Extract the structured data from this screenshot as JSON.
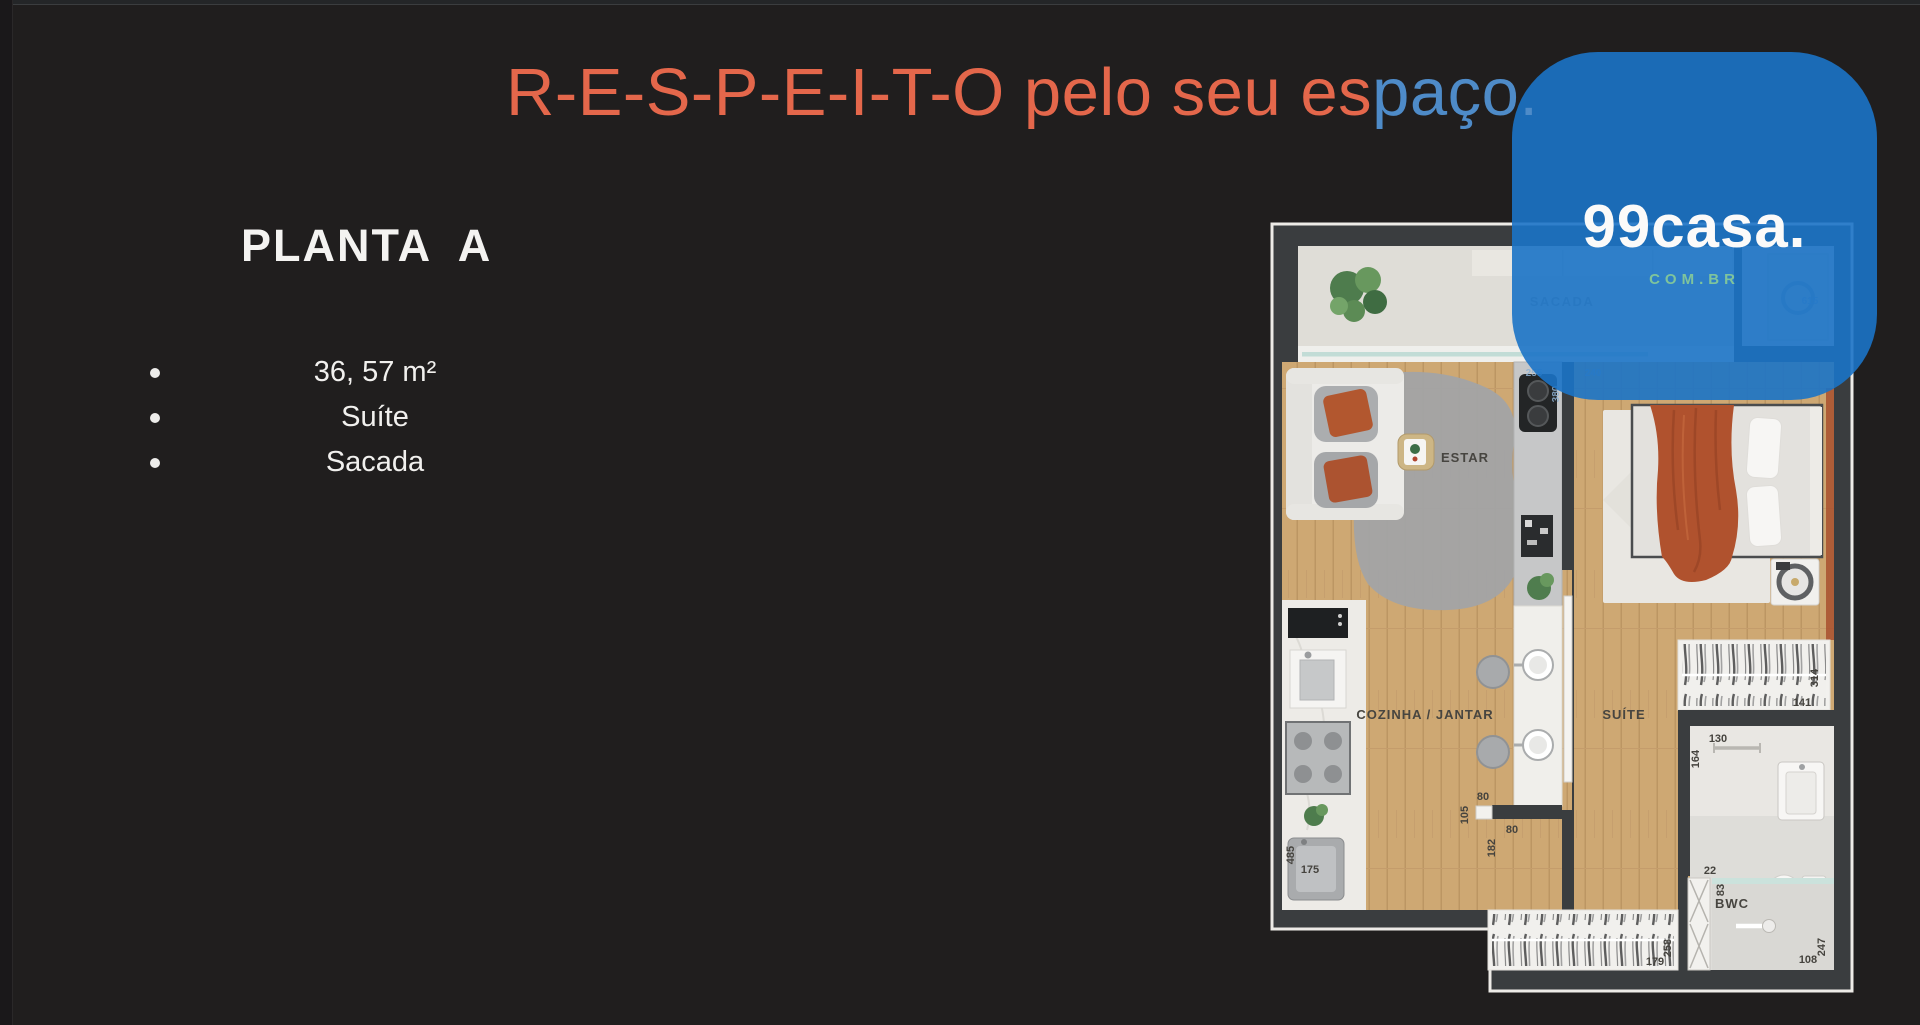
{
  "title": {
    "highlight": "R-E-S-P-E-I-T-O pelo seu es",
    "rest": "paço."
  },
  "panel": {
    "heading": "PLANTA  A",
    "bullets": [
      "36, 57 m²",
      "Suíte",
      "Sacada"
    ]
  },
  "logo": {
    "brand": "99casa.",
    "domain": "COM.BR"
  },
  "plan": {
    "rooms": {
      "sacada": "SACADA",
      "estar": "ESTAR",
      "cozinha_jantar": "COZINHA / JANTAR",
      "suite": "SUÍTE",
      "bwc": "BWC"
    },
    "dims": {
      "balcony_615": "615",
      "door_255": "255",
      "door_240": "240",
      "door_380": "380",
      "pass_80a": "80",
      "pass_105": "105",
      "pass_80b": "80",
      "pass_182": "182",
      "bath_130": "130",
      "bath_164": "164",
      "bath_22": "22",
      "bath_83": "83",
      "closet_141": "141",
      "closet_314": "314",
      "wardrobe_179": "179",
      "wardrobe_258": "258",
      "shower_108": "108",
      "shower_247": "247",
      "tub_485": "485",
      "tub_175": "175"
    }
  },
  "colors": {
    "background": "#201E1E",
    "accent_orange": "#E4674B",
    "logo_blue": "#1B73C6",
    "domain_green": "#7FC49C",
    "wall": "#3A3D3F",
    "wood": "#CEA873",
    "blanket_orange": "#B0522E"
  }
}
